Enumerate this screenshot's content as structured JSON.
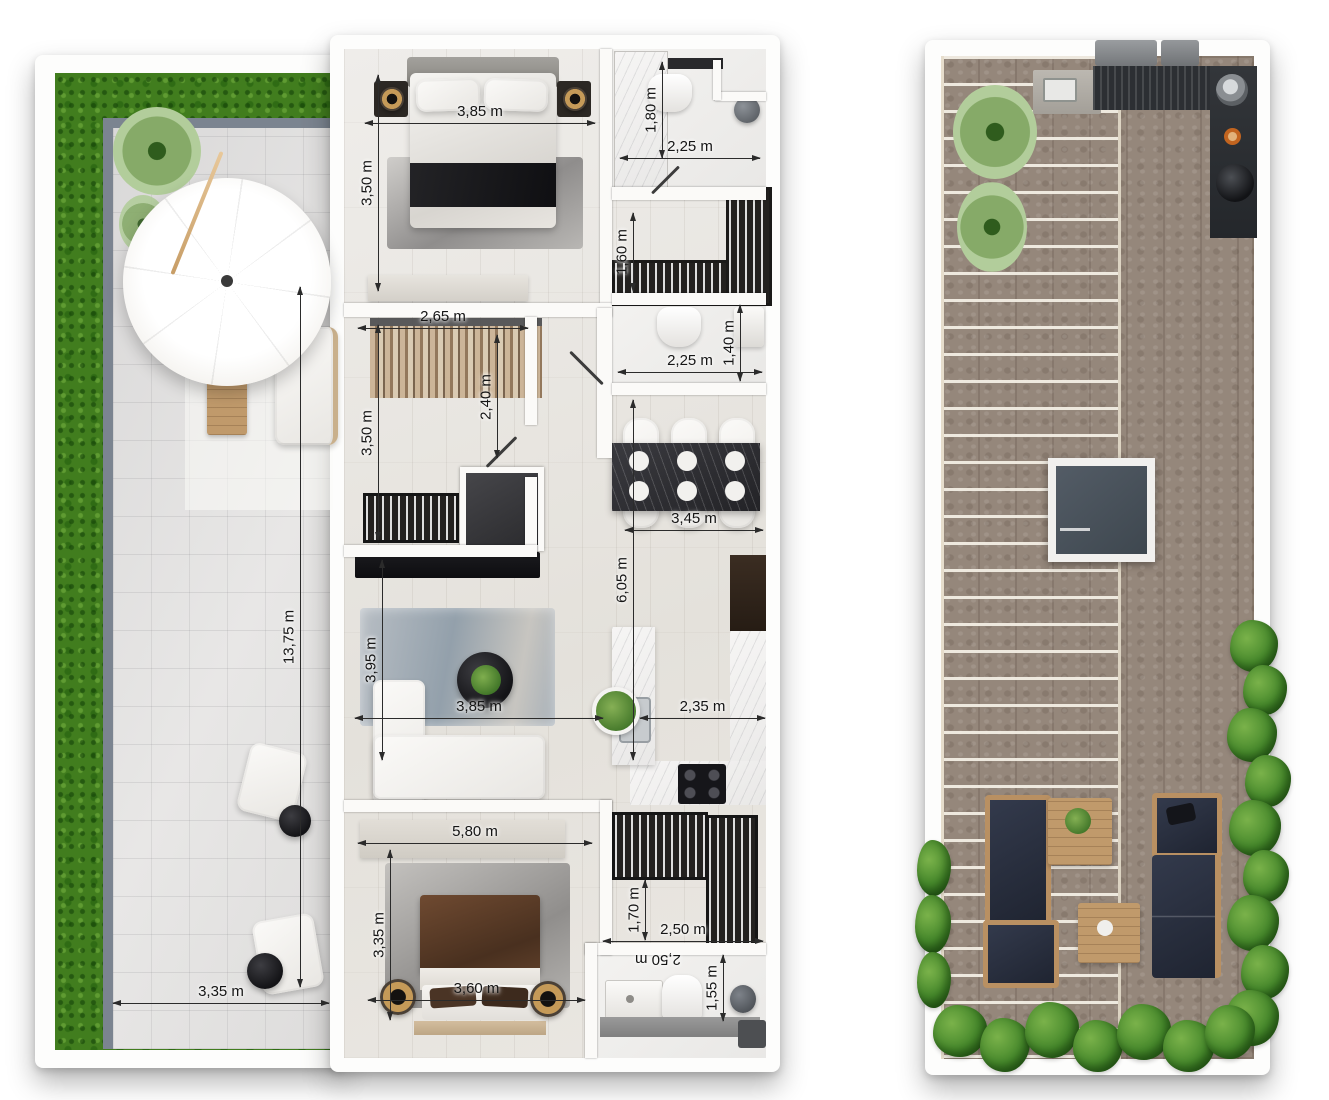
{
  "plan": {
    "terrace": {
      "length": "13,75 m",
      "width": "3,35 m"
    },
    "bedroom1": {
      "width": "3,85 m",
      "depth": "3,50 m"
    },
    "bathroom1": {
      "depth": "1,80 m",
      "width": "2,25 m"
    },
    "hall_closet": {
      "depth": "1,60 m"
    },
    "bathroom2": {
      "width": "2,25 m",
      "depth": "1,40 m"
    },
    "dressing_room": {
      "width": "2,65 m",
      "inner_depth": "2,40 m",
      "depth": "3,50 m"
    },
    "dining": {
      "width": "3,45 m"
    },
    "living_kitchen": {
      "length": "6,05 m",
      "living_depth": "3,95 m",
      "living_width": "3,85 m",
      "kitchen_width": "2,35 m"
    },
    "bedroom2": {
      "width": "5,80 m",
      "depth": "3,35 m",
      "bed_width": "3,60 m"
    },
    "closet": {
      "depth": "1,70 m"
    },
    "bathroom3": {
      "width": "2,50 m",
      "width_rotated": "2,50 m",
      "depth": "1,55 m"
    }
  },
  "colors": {
    "grass": "#417d1e",
    "hedge": "#47892c",
    "deck": "#95877b",
    "patio_border": "#7b8490",
    "wood": "#c09a6b",
    "cushion_navy": "#262c3a",
    "dim_line": "#2b2b2b",
    "wall": "#fbfaf8"
  }
}
